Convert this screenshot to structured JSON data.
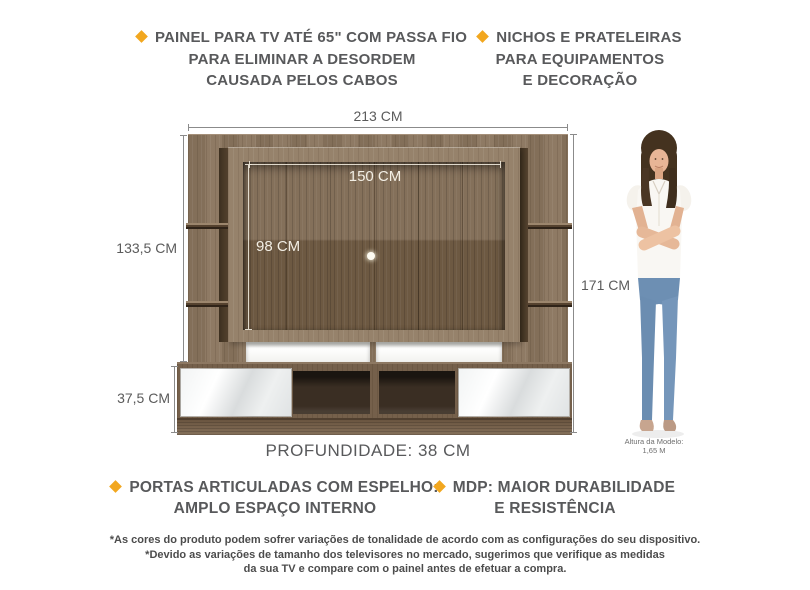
{
  "features": {
    "top_left": {
      "icon": "diamond-bullet",
      "lines": [
        "PAINEL PARA TV ATÉ 65\" COM PASSA FIO",
        "PARA ELIMINAR A DESORDEM",
        "CAUSADA PELOS CABOS"
      ]
    },
    "top_right": {
      "icon": "diamond-bullet",
      "lines": [
        "NICHOS E PRATELEIRAS",
        "PARA EQUIPAMENTOS",
        "E DECORAÇÃO"
      ]
    },
    "bottom_left": {
      "icon": "diamond-bullet",
      "lines": [
        "PORTAS ARTICULADAS COM ESPELHO:",
        "AMPLO ESPAÇO INTERNO"
      ]
    },
    "bottom_right": {
      "icon": "diamond-bullet",
      "lines": [
        "MDP: MAIOR DURABILIDADE",
        "E RESISTÊNCIA"
      ]
    }
  },
  "dimensions": {
    "total_width": "213 CM",
    "tv_area_width": "150 CM",
    "tv_area_height": "98 CM",
    "upper_section_height": "133,5 CM",
    "lower_section_height": "37,5 CM",
    "total_height": "171 CM",
    "depth": "PROFUNDIDADE: 38 CM"
  },
  "model": {
    "caption": [
      "Altura da Modelo:",
      "1,65 M"
    ]
  },
  "disclaimer": [
    "*As cores do produto podem sofrer variações de tonalidade de acordo com as configurações do seu dispositivo.",
    "*Devido as variações de tamanho dos televisores no mercado, sugerimos que verifique as medidas",
    "da sua TV e compare com o painel antes de efetuar a compra."
  ],
  "colors": {
    "accent": "#F2A71F",
    "heading_text": "#58595B",
    "wood": "#8A755E",
    "wood_recess": "#6D5942",
    "cabinet_interior": "#3A2E23",
    "mirror": "#E9EBEC"
  }
}
